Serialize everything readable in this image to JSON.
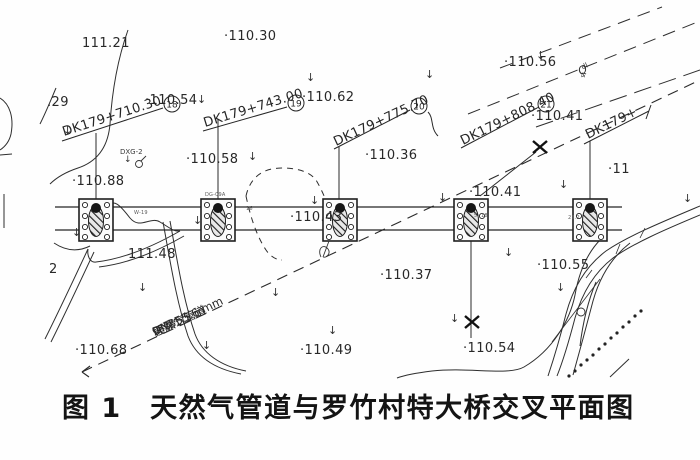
{
  "caption": {
    "text": "图 1　天然气管道与罗竹村特大桥交叉平面图"
  },
  "stations": [
    {
      "label": "DK179+710.30",
      "bubble": "18"
    },
    {
      "label": "DK179+743.00",
      "bubble": "19"
    },
    {
      "label": "DK179+775.70",
      "bubble": "20"
    },
    {
      "label": "DK179+808.40",
      "bubble": "21"
    },
    {
      "label": "DK179+",
      "bubble": ""
    }
  ],
  "pipeline": {
    "name": "天然气管道",
    "tag": "QR阀",
    "diameter": "DN355.6 mm",
    "depth": "埋深1.5 m"
  },
  "geology": {
    "base": "Q",
    "sub": "4",
    "sup": "dl"
  },
  "labels": {
    "dxg": "DXG-2",
    "contour_number": "2"
  },
  "icons": {
    "down_arrow": "↓"
  },
  "spot_elevations": [
    {
      "text": "111.21",
      "x": 82,
      "y": 36
    },
    {
      "text": "·110.30",
      "x": 224,
      "y": 29
    },
    {
      "text": "·110.56",
      "x": 504,
      "y": 55
    },
    {
      "text": "·110.54",
      "x": 145,
      "y": 93
    },
    {
      "text": "·110.62",
      "x": 302,
      "y": 90
    },
    {
      "text": "·110.41",
      "x": 531,
      "y": 109
    },
    {
      "text": "·110.88",
      "x": 72,
      "y": 174
    },
    {
      "text": "·110.58",
      "x": 186,
      "y": 152
    },
    {
      "text": "·110.36",
      "x": 365,
      "y": 148
    },
    {
      "text": "·110.43",
      "x": 290,
      "y": 210
    },
    {
      "text": "·110.41",
      "x": 469,
      "y": 185
    },
    {
      "text": "111.48",
      "x": 128,
      "y": 247
    },
    {
      "text": "·110.37",
      "x": 380,
      "y": 268
    },
    {
      "text": "·110.49",
      "x": 300,
      "y": 343
    },
    {
      "text": "·110.55",
      "x": 537,
      "y": 258
    },
    {
      "text": "·110.54",
      "x": 463,
      "y": 341
    },
    {
      "text": "·110.68",
      "x": 75,
      "y": 343
    },
    {
      "text": "·11",
      "x": 608,
      "y": 162
    },
    {
      "text": ".29",
      "x": 47,
      "y": 95
    },
    {
      "text": "2",
      "x": 49,
      "y": 262
    }
  ],
  "flow_arrows": [
    {
      "x": 63,
      "y": 124
    },
    {
      "x": 197,
      "y": 93
    },
    {
      "x": 306,
      "y": 71
    },
    {
      "x": 425,
      "y": 68
    },
    {
      "x": 536,
      "y": 49
    },
    {
      "x": 248,
      "y": 150
    },
    {
      "x": 310,
      "y": 194
    },
    {
      "x": 438,
      "y": 191
    },
    {
      "x": 559,
      "y": 178
    },
    {
      "x": 683,
      "y": 192
    },
    {
      "x": 72,
      "y": 226
    },
    {
      "x": 193,
      "y": 214
    },
    {
      "x": 504,
      "y": 246
    },
    {
      "x": 138,
      "y": 281
    },
    {
      "x": 202,
      "y": 339
    },
    {
      "x": 271,
      "y": 286
    },
    {
      "x": 328,
      "y": 324
    },
    {
      "x": 450,
      "y": 312
    },
    {
      "x": 556,
      "y": 281
    }
  ],
  "pier_tags": [
    {
      "text": "W-19",
      "x": 134,
      "y": 210
    },
    {
      "text": "DG-09A",
      "x": 205,
      "y": 192
    },
    {
      "text": "16",
      "x": 246,
      "y": 206
    },
    {
      "text": "5. 18",
      "x": 474,
      "y": 213
    },
    {
      "text": "21.2",
      "x": 568,
      "y": 215
    }
  ]
}
